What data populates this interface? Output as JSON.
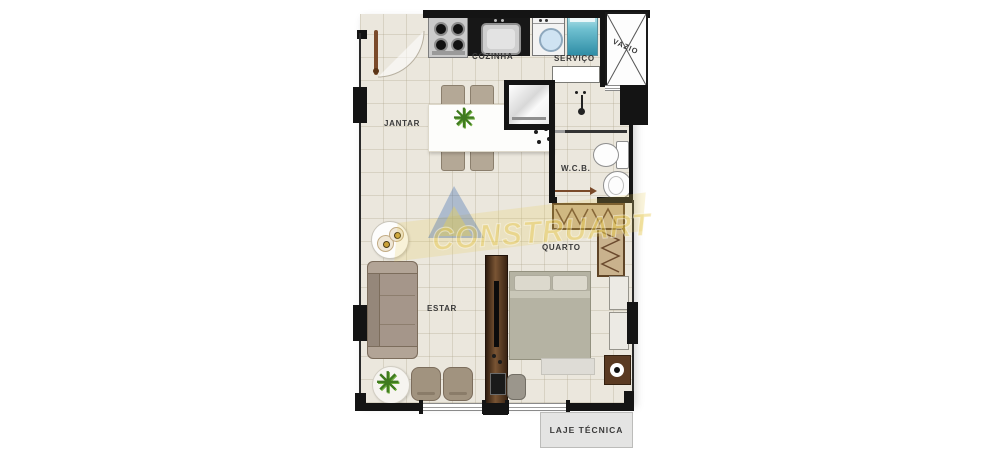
{
  "plan": {
    "labels": {
      "cozinha": "COZINHA",
      "servico": "SERVIÇO",
      "vazio": "VAZIO",
      "jantar": "JANTAR",
      "wcb": "W.C.B.",
      "quarto": "QUARTO",
      "estar": "ESTAR",
      "laje_tecnica": "LAJE TÉCNICA"
    },
    "watermark": {
      "text": "CONSTRUART",
      "yellow": "#e8c84a",
      "blue": "#2a5caa"
    },
    "colors": {
      "floor": "#ebe7dd",
      "wall": "#141414",
      "closet": "#c9b28d",
      "bed": "#b5b3a3",
      "sofa": "#a5968a",
      "wood_dark": "#5a3a22",
      "laundry_tank": "#55aec2",
      "washer_glass": "#cfe3f2",
      "laje_bg": "#e4e4e3"
    }
  }
}
